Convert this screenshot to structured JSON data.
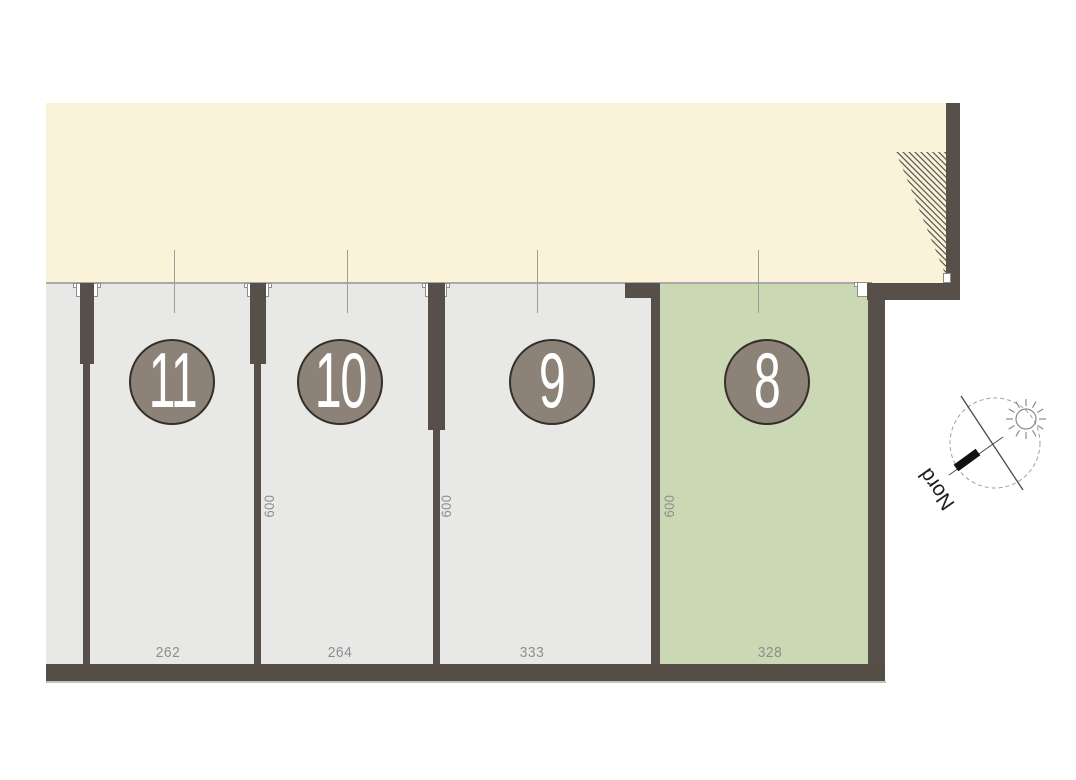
{
  "plan": {
    "plots": [
      {
        "number": "11",
        "width_label": "262"
      },
      {
        "number": "10",
        "width_label": "264",
        "depth_label": "600"
      },
      {
        "number": "9",
        "width_label": "333",
        "depth_label": "600"
      },
      {
        "number": "8",
        "width_label": "328",
        "depth_label": "600",
        "highlighted": true
      }
    ],
    "north": {
      "label": "Nord"
    },
    "colors": {
      "corridor": "#faf3da",
      "plot": "#e8e8e7",
      "plot_highlighted": "#cbd8b4",
      "wall": "#57504a",
      "badge_fill": "#8c8277",
      "badge_text": "#ffffff",
      "dimension_text": "#8d8d8d"
    }
  }
}
